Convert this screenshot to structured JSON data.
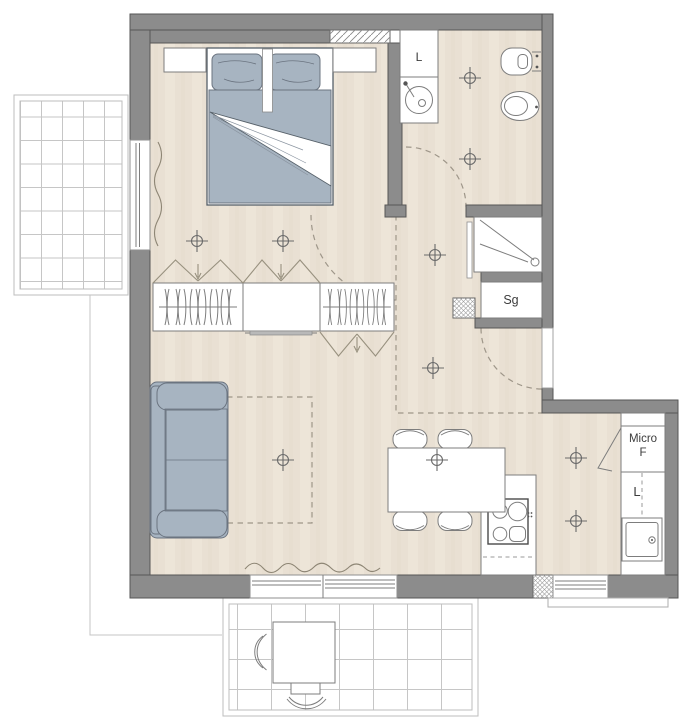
{
  "labels": {
    "bath_washer": "L",
    "storage": "Sg",
    "micro_line1": "Micro",
    "micro_line2": "F",
    "kitchen_appliance": "L"
  },
  "colors": {
    "wall": "#8c8c8c",
    "wall-line": "#565656",
    "floor": "#e9e0d3",
    "floor-streak": "#f1e9dc",
    "floor-streak2": "#e2d8c7",
    "uph": "#a7b4c1",
    "uph-line": "#6b7480",
    "fixture": "#7d7d7d",
    "dash": "#9e9689",
    "grid": "#c6c6c6",
    "bg": "#ffffff"
  }
}
